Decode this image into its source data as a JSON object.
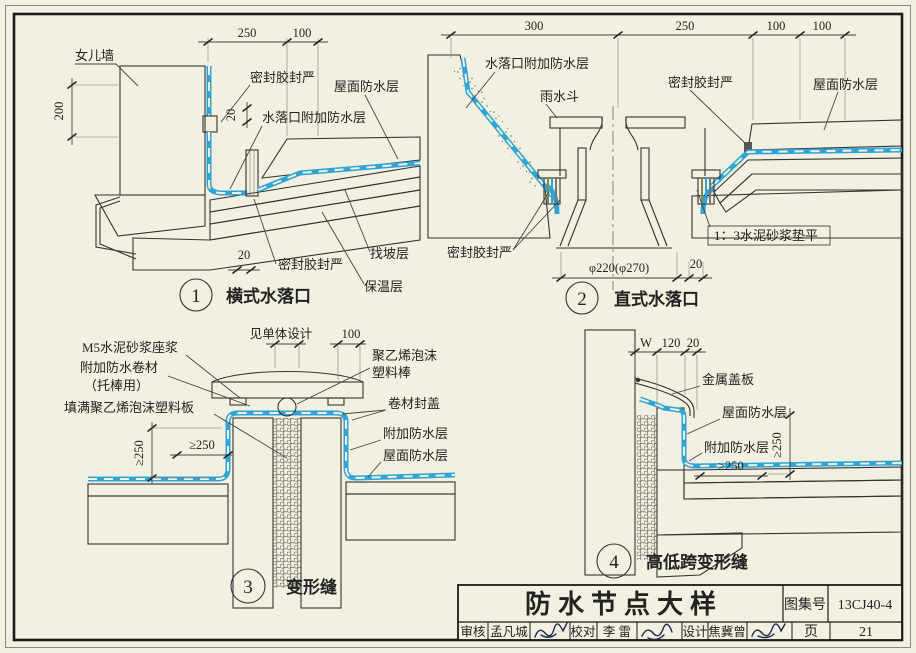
{
  "page": {
    "background": "#f2f0e0",
    "ink": "#333333",
    "membrane_blue": "#2ea5d6"
  },
  "drawings": {
    "d1": {
      "number": "1",
      "title": "横式水落口",
      "dim_top_left": "250",
      "dim_top_right": "100",
      "dim_wall_height": "200",
      "dim_seal_gap": "20",
      "dim_outlet": "20",
      "label_parapet": "女儿墙",
      "label_sealant_top": "密封胶封严",
      "label_roof_membrane": "屋面防水层",
      "label_outlet_membrane": "水落口附加防水层",
      "label_sealant_bottom": "密封胶封严",
      "label_screed": "找坡层",
      "label_insulation": "保温层"
    },
    "d2": {
      "number": "2",
      "title": "直式水落口",
      "dim_1": "300",
      "dim_2": "250",
      "dim_3": "100",
      "dim_4": "100",
      "dim_diameter": "φ220(φ270)",
      "dim_gap": "20",
      "label_outlet_membrane": "水落口附加防水层",
      "label_hopper": "雨水斗",
      "label_sealant_top": "密封胶封严",
      "label_roof_membrane": "屋面防水层",
      "label_sealant_left": "密封胶封严",
      "label_mortar": "1：3水泥砂浆垫平"
    },
    "d3": {
      "number": "3",
      "title": "变形缝",
      "dim_top": "见单体设计",
      "dim_100": "100",
      "dim_v250": "≥250",
      "dim_h250": "≥250",
      "label_m5": "M5水泥砂浆座浆",
      "label_added_roll": "附加防水卷材",
      "label_added_roll_2": "（托棒用）",
      "label_fill": "填满聚乙烯泡沫塑料板",
      "label_rod_1": "聚乙烯泡沫",
      "label_rod_2": "塑料棒",
      "label_cap": "卷材封盖",
      "label_added_membrane": "附加防水层",
      "label_roof_membrane": "屋面防水层"
    },
    "d4": {
      "number": "4",
      "title": "高低跨变形缝",
      "dim_w": "W",
      "dim_120": "120",
      "dim_20": "20",
      "dim_h250": "≥250",
      "dim_v250": "≥250",
      "label_cover": "金属盖板",
      "label_roof_membrane": "屋面防水层",
      "label_added_membrane": "附加防水层"
    }
  },
  "title_block": {
    "title": "防水节点大样",
    "atlas_label": "图集号",
    "atlas_no": "13CJ40-4",
    "page_label": "页",
    "page_no": "21",
    "review_label": "审核",
    "reviewer": "孟凡城",
    "check_label": "校对",
    "checker": "李  雷",
    "design_label": "设计",
    "designer": "焦冀曾"
  }
}
